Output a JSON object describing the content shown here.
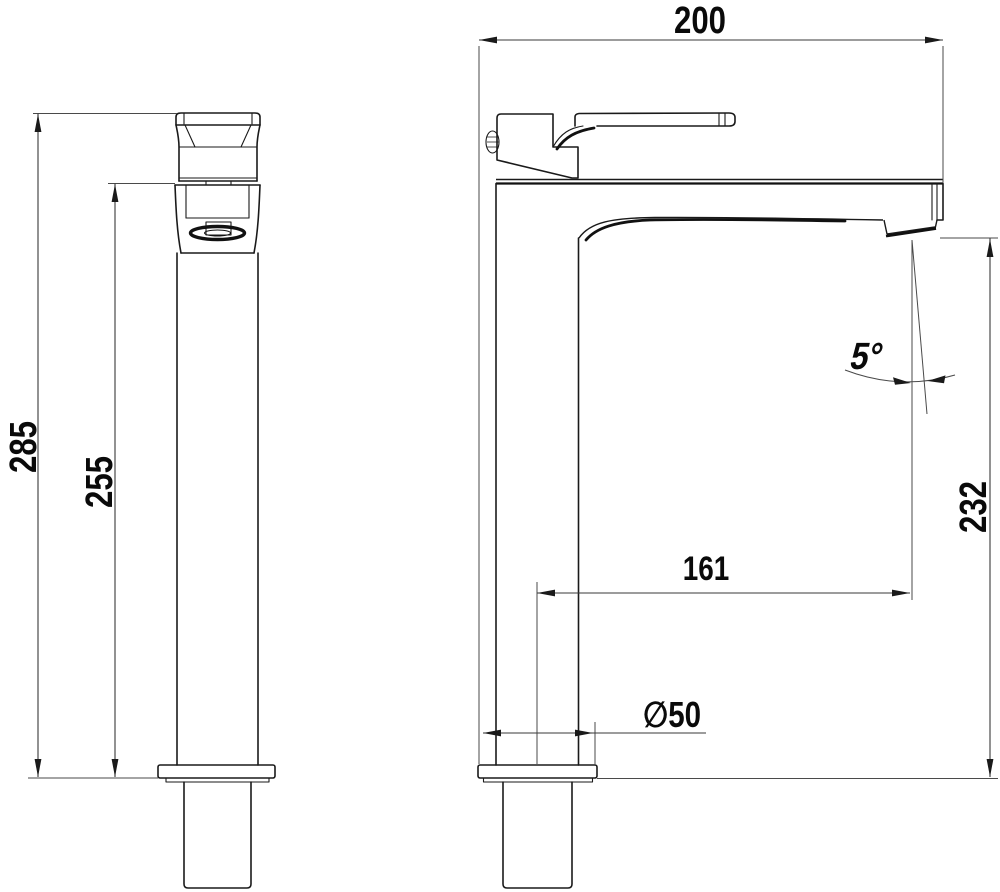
{
  "drawing": {
    "dimensions": {
      "overall_width": "200",
      "overall_height": "285",
      "body_height": "255",
      "spout_height": "232",
      "spout_reach": "161",
      "base_diameter": "∅50",
      "spout_angle": "5°"
    }
  }
}
